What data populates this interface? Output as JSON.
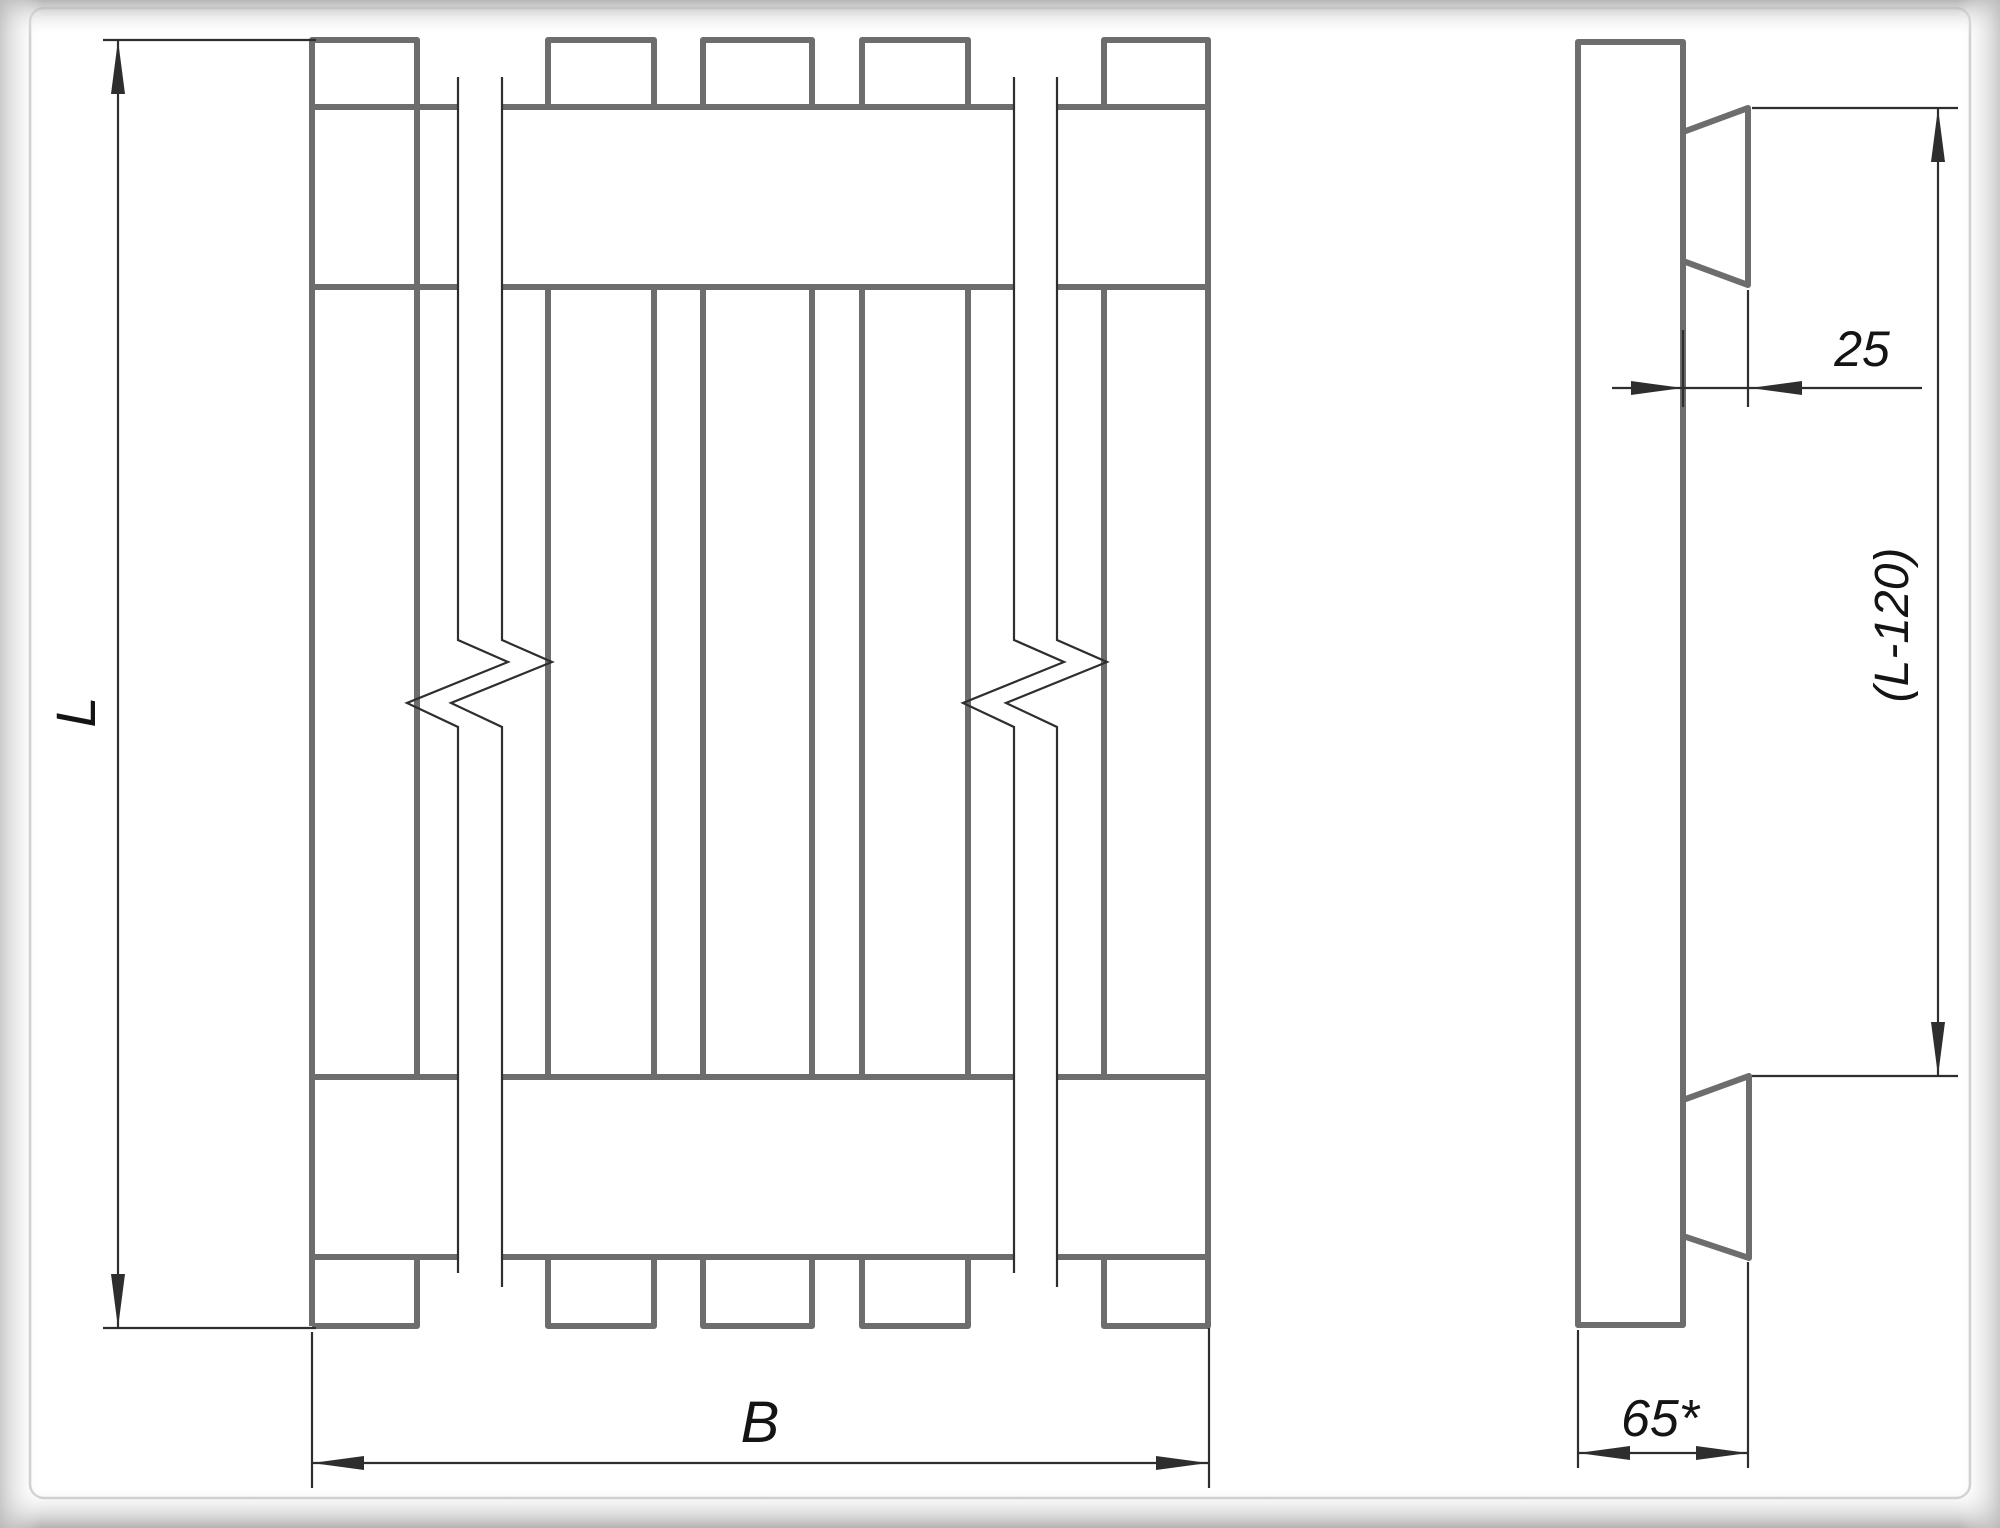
{
  "page": {
    "labels": {
      "length": "L",
      "width": "B",
      "cleat_thickness": "25",
      "cleat_offset_length": "(L-120)",
      "stringer_width": "65*"
    },
    "colors": {
      "outline_gray": "#6d6d6d",
      "dimension_dark": "#2e2e2e",
      "label_text": "#141414",
      "frame_border": "#c8c8c8"
    }
  }
}
